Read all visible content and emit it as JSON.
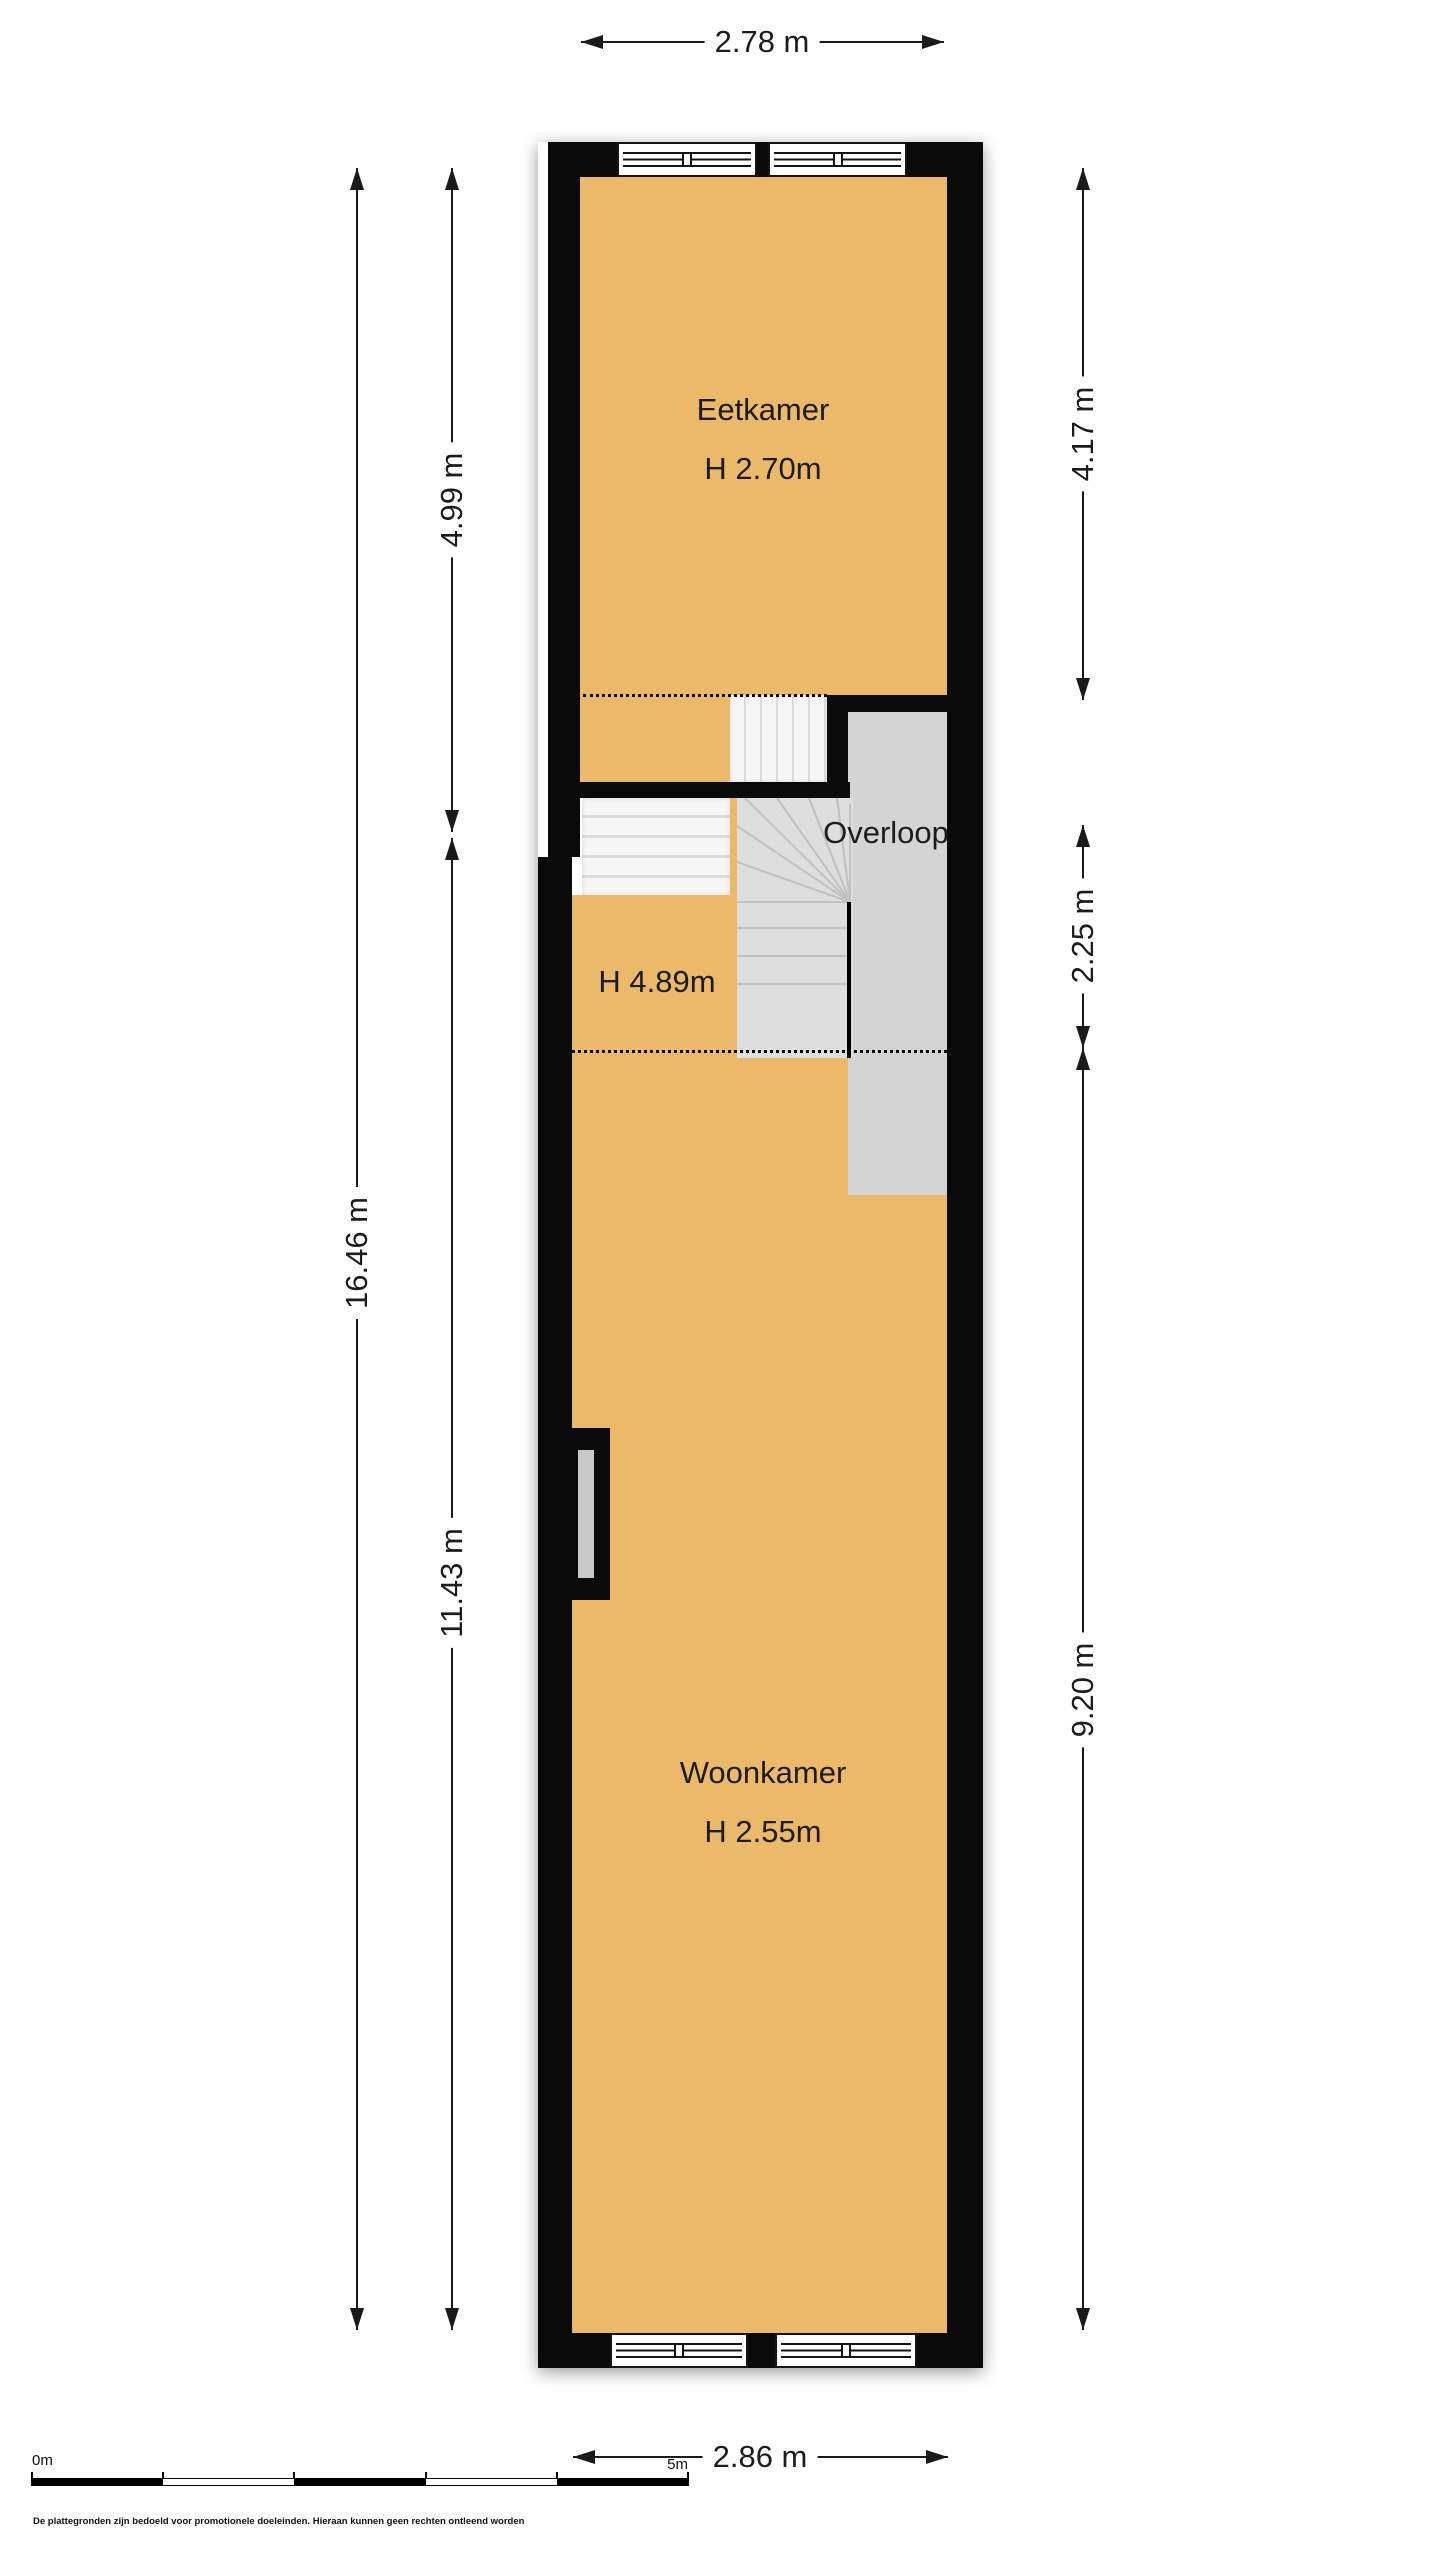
{
  "plan_title": "Floor plan (verdieping)",
  "rooms": {
    "eetkamer": {
      "name": "Eetkamer",
      "ceiling": "H 2.70m"
    },
    "overloop": {
      "name": "Overloop"
    },
    "woonkamer": {
      "name": "Woonkamer",
      "ceiling": "H 2.55m"
    },
    "stairwell": {
      "ceiling": "H 4.89m"
    }
  },
  "dimensions": {
    "top": "2.78 m",
    "bottom": "2.86 m",
    "left_total": "16.46 m",
    "left_upper": "4.99 m",
    "left_lower": "11.43 m",
    "right_upper": "4.17 m",
    "right_middle": "2.25 m",
    "right_lower": "9.20 m"
  },
  "scale_bar": {
    "zero": "0m",
    "five": "5m"
  },
  "footer": {
    "disclaimer": "De plattegronden zijn bedoeld voor promotionele doeleinden. Hieraan kunnen geen rechten ontleend worden"
  },
  "colors": {
    "floor": "#ecb96b",
    "wall": "#0a0a0a",
    "landing": "#d4d4d4",
    "stair": "#f5f5f5"
  }
}
